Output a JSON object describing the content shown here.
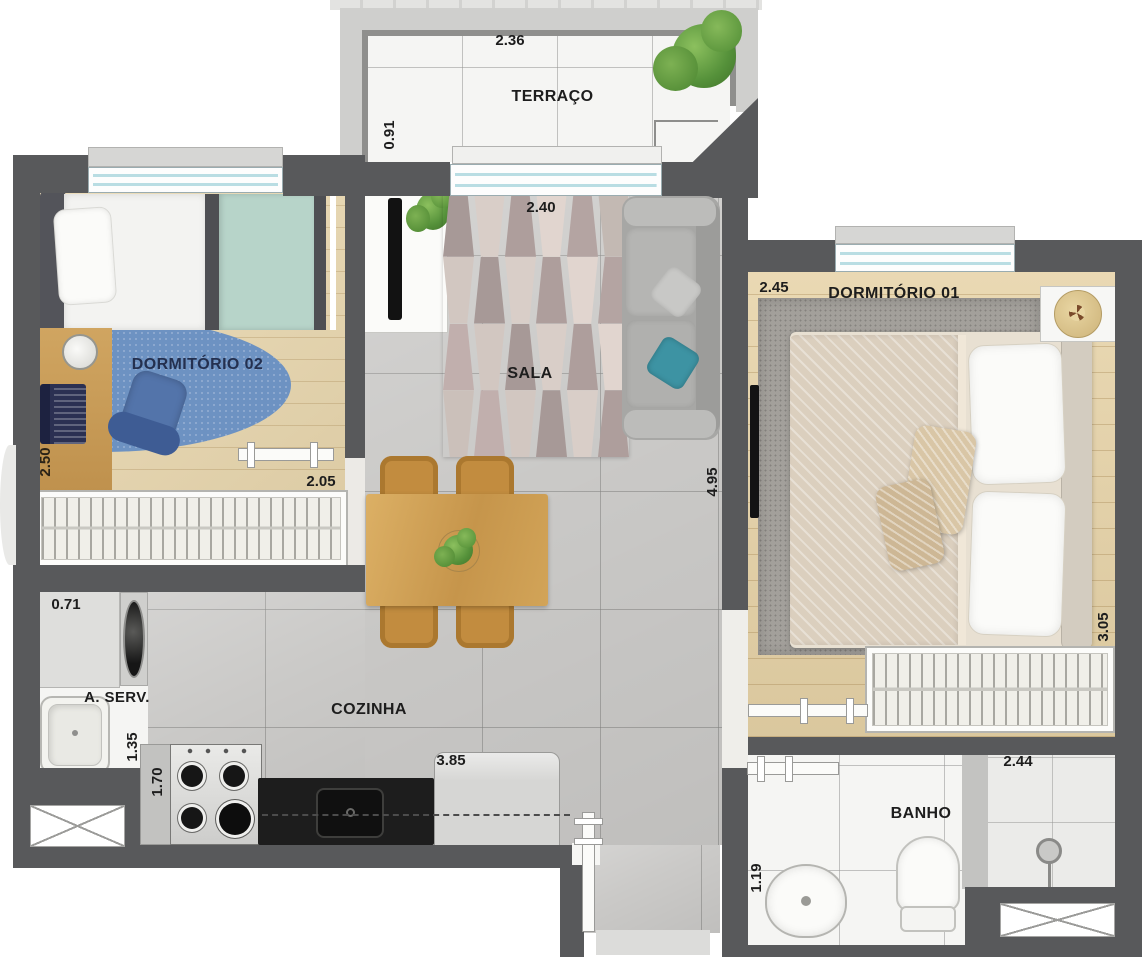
{
  "plan_title": "apartment-floor-plan",
  "colors": {
    "wall": "#58595b",
    "rug_sala_a": "#b4a4a2",
    "rug_sala_b": "#d2c7c1",
    "rug_blue": "#6d92c2",
    "accent_teal": "#3d93a3"
  },
  "rooms": {
    "terraco": {
      "label": "TERRAÇO",
      "dim_width": "2.36",
      "dim_depth": "0.91"
    },
    "dormitorio02": {
      "label": "DORMITÓRIO 02",
      "dim_width": "2.05",
      "dim_depth": "2.50"
    },
    "sala": {
      "label": "SALA",
      "dim_width": "2.40",
      "dim_depth": "4.95"
    },
    "dormitorio01": {
      "label": "DORMITÓRIO 01",
      "dim_width": "2.45",
      "dim_depth": "3.05"
    },
    "area_servico": {
      "label": "A. SERV.",
      "dim_width": "0.71",
      "dim_depth": "1.35"
    },
    "cozinha": {
      "label": "COZINHA",
      "dim_width": "3.85",
      "dim_depth": "1.70"
    },
    "banho": {
      "label": "BANHO",
      "dim_width": "2.44",
      "dim_depth": "1.19"
    }
  }
}
